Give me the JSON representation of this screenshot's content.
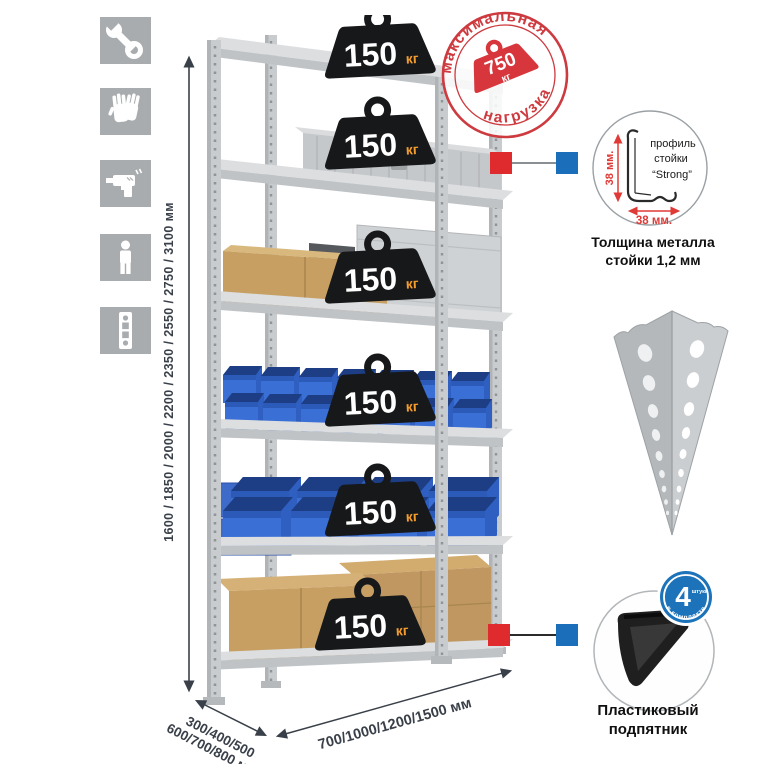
{
  "height_dimension": {
    "label": "1600 / 1850 / 2000 / 2200 / 2350 / 2550 / 2750 / 3100 мм"
  },
  "rack": {
    "badges": [
      {
        "value": "150",
        "unit": "кг"
      },
      {
        "value": "150",
        "unit": "кг"
      },
      {
        "value": "150",
        "unit": "кг"
      },
      {
        "value": "150",
        "unit": "кг"
      },
      {
        "value": "150",
        "unit": "кг"
      },
      {
        "value": "150",
        "unit": "кг"
      }
    ]
  },
  "stamp": {
    "arc_top": "максимальная",
    "arc_bottom": "нагрузка",
    "value": "750",
    "unit": "кг"
  },
  "profile": {
    "dim_vertical": "38 мм.",
    "dim_horizontal": "38 мм.",
    "caption_line1": "профиль",
    "caption_line2": "стойки",
    "caption_line3": "“Strong”",
    "note_line1": "Толщина металла",
    "note_line2": "стойки 1,2 мм"
  },
  "foot": {
    "badge_value": "4",
    "badge_small": "штуки",
    "badge_arc": "в комплекте",
    "caption_line1": "Пластиковый",
    "caption_line2": "подпятник"
  },
  "dims": {
    "depth_line1": "300/400/500",
    "depth_line2": "600/700/800 мм",
    "width_label": "700/1000/1200/1500 мм"
  },
  "icons": {
    "items": [
      "wrench",
      "gloves",
      "drill",
      "person",
      "upright-post"
    ]
  },
  "colors": {
    "stamp_red": "#d6363c",
    "marker_red": "#e02b2e",
    "marker_blue": "#1b6fba",
    "badge_black": "#17181a",
    "unit_orange": "#f59d2c",
    "metal_gray": "#c9ccce",
    "bin_blue": "#3a6fd6",
    "cardboard": "#c79f63",
    "icon_tile_gray": "#a9acae",
    "dim_text": "#3a4049"
  }
}
